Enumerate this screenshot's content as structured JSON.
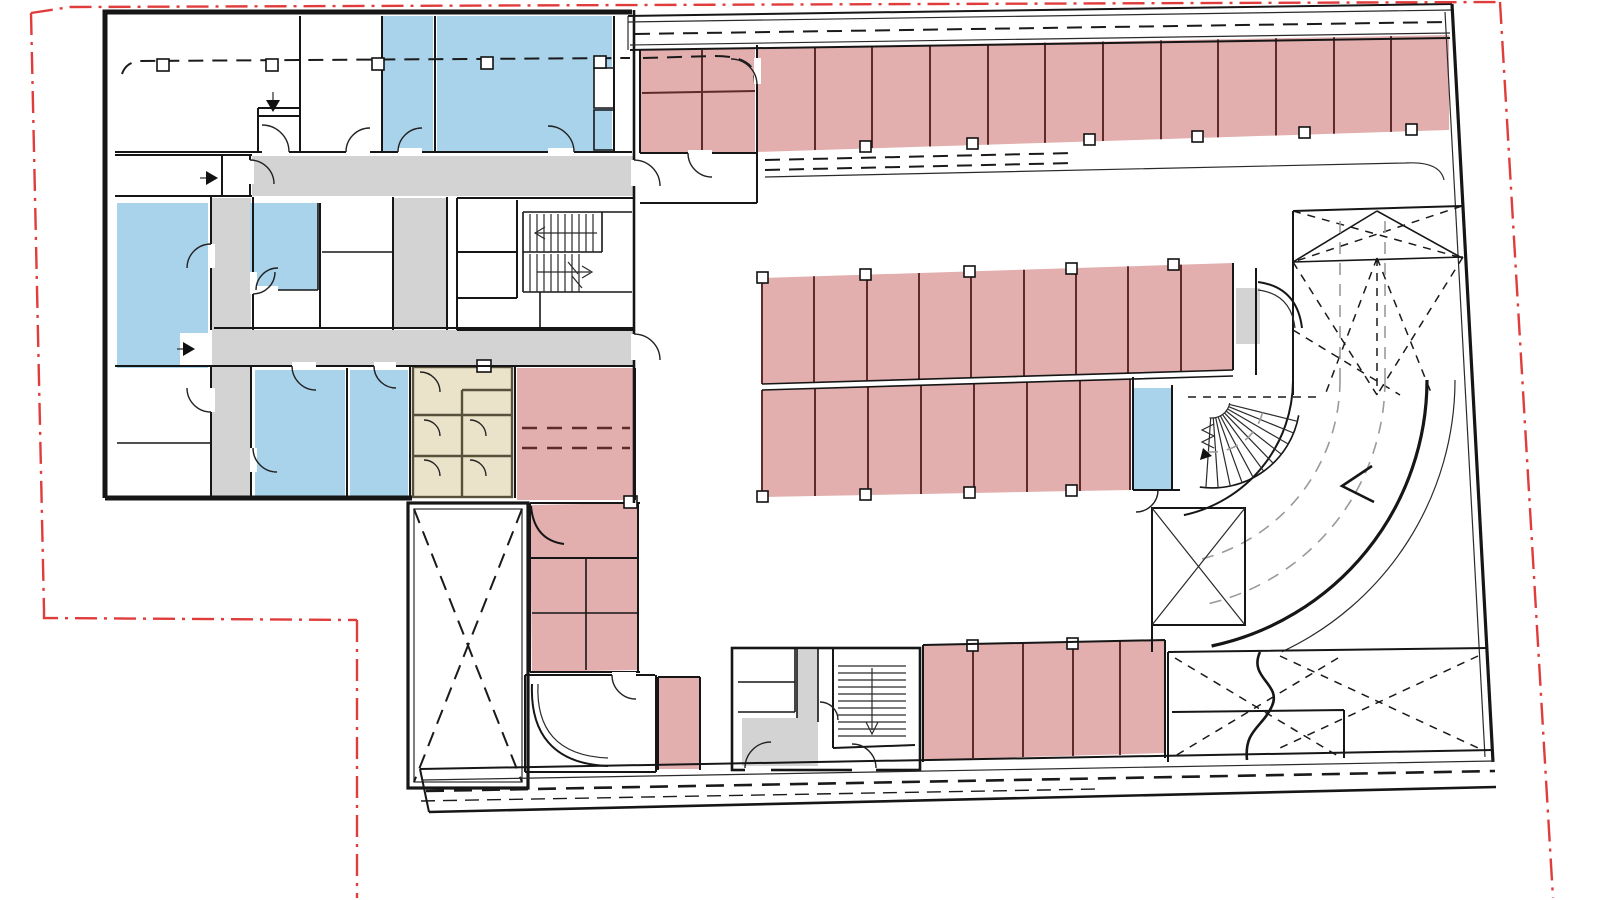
{
  "document": {
    "kind": "architectural floor plan",
    "content": "parking level with room wing",
    "visible_text": []
  },
  "colors": {
    "page_bg": "#ffffff",
    "walls": "#161616",
    "thin_lines": "#2a2a2a",
    "parking": "#E2AEAE",
    "stall_divider": "#5E2A2A",
    "rooms": "#A9D3EA",
    "sanitary": "#EBE3C9",
    "sanitary_wall": "#57513C",
    "circulation": "#D3D3D3",
    "boundary": "#E03C3C",
    "guides": "#9A9A9A"
  },
  "zones": [
    {
      "name": "parking-stalls",
      "color_ref": "parking"
    },
    {
      "name": "rooms-blue",
      "color_ref": "rooms"
    },
    {
      "name": "sanitary-cluster",
      "color_ref": "sanitary"
    },
    {
      "name": "circulation-corridors",
      "color_ref": "circulation"
    }
  ],
  "counts": {
    "north_row_stalls": 12,
    "north_small_group_stalls": 4,
    "island_north_stalls": 9,
    "island_south_stalls": 7,
    "south_row_stalls": 5,
    "southwest_column_stalls": 6,
    "single_south_stall": 1
  },
  "linework": {
    "property_boundary": "red dash-dot",
    "overhead_elements": "black dashed",
    "ramp_guides": "gray dashed arcs"
  }
}
